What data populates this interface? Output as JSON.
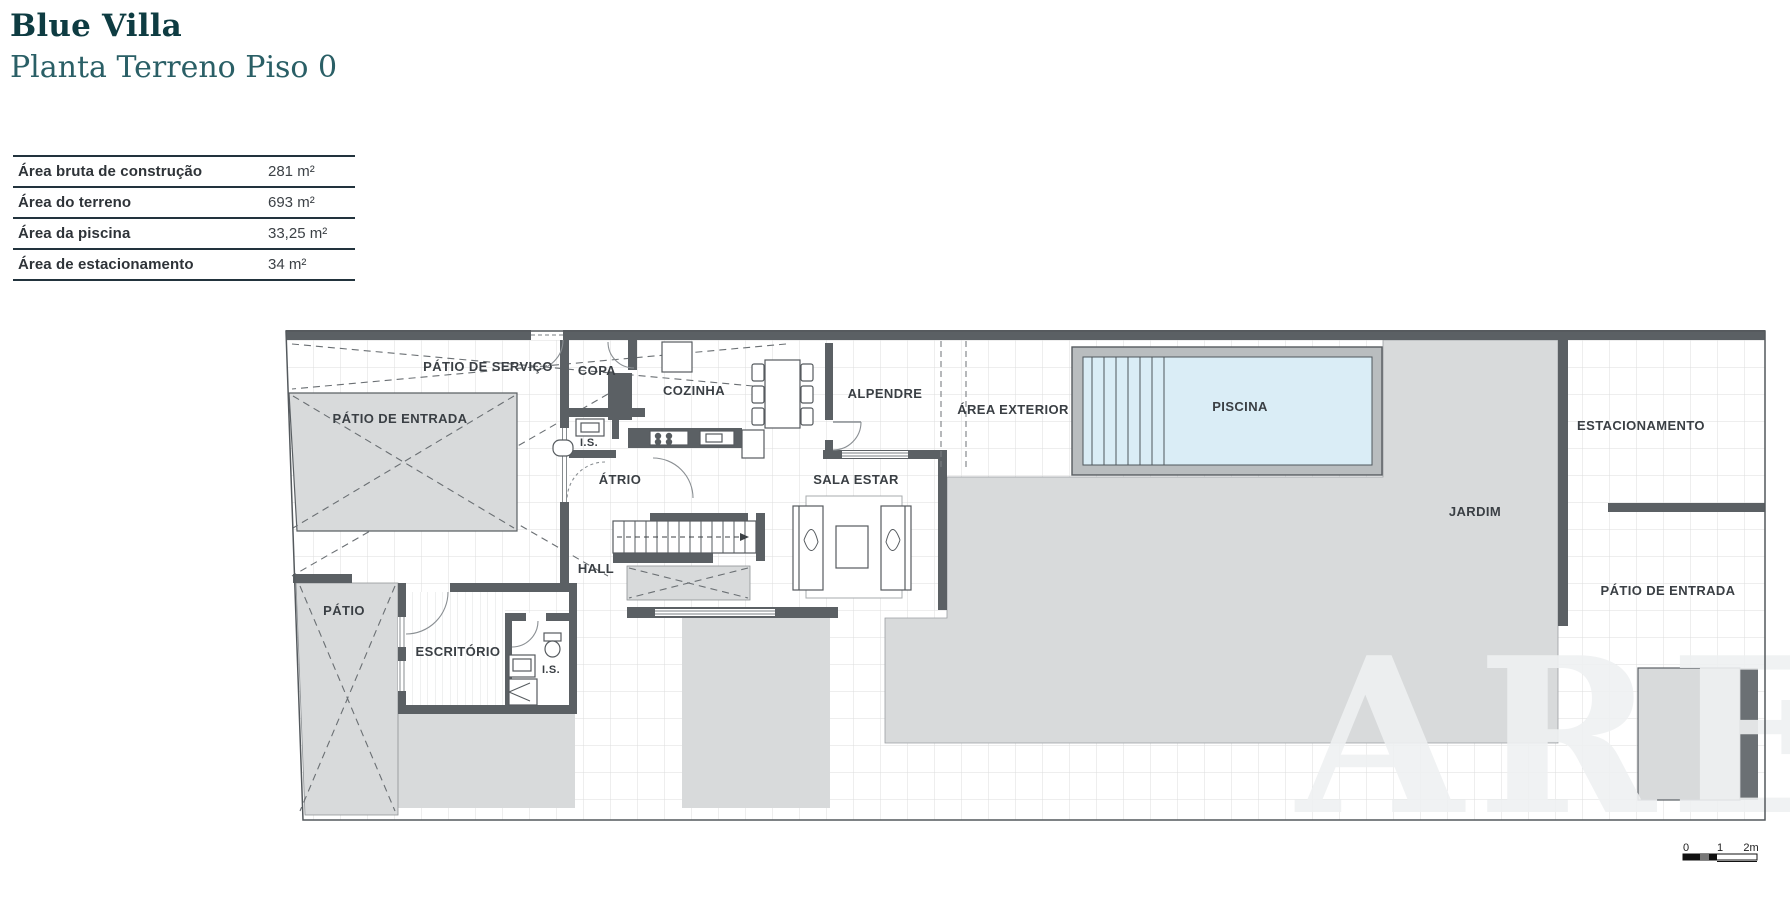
{
  "header": {
    "title": "Blue Villa",
    "subtitle": "Planta Terreno Piso 0"
  },
  "area_table": {
    "rows": [
      {
        "label": "Área bruta de construção",
        "value": "281 m²"
      },
      {
        "label": "Área do terreno",
        "value": "693 m²"
      },
      {
        "label": "Área da piscina",
        "value": "33,25 m²"
      },
      {
        "label": "Área de estacionamento",
        "value": "34 m²"
      }
    ]
  },
  "floor_plan": {
    "rooms": {
      "patio_de_servico": "PÁTIO DE SERVIÇO",
      "patio_de_entrada": "PÁTIO DE ENTRADA",
      "copa": "COPA",
      "cozinha": "COZINHA",
      "is_piso0": "I.S.",
      "atrio": "ÁTRIO",
      "hall": "HALL",
      "alpendre": "ALPENDRE",
      "sala_estar": "SALA ESTAR",
      "area_exterior": "ÁREA EXTERIOR",
      "piscina": "PISCINA",
      "jardim": "JARDIM",
      "estacionamento": "ESTACIONAMENTO",
      "patio_de_entrada_direita": "PÁTIO DE ENTRADA",
      "patio": "PÁTIO",
      "escritorio": "ESCRITÓRIO",
      "is_escritorio": "I.S."
    },
    "scale_bar": {
      "start": "0",
      "mid": "1",
      "end": "2m"
    },
    "watermark": "ARE",
    "colors": {
      "wall": "#5b6064",
      "paving_gray": "#d8dadb",
      "pool_water": "#daedf6",
      "pool_frame": "#b9bdbf",
      "title_teal": "#0e3c42",
      "subtitle_teal": "#2a5f66",
      "table_border": "#22333d"
    }
  }
}
